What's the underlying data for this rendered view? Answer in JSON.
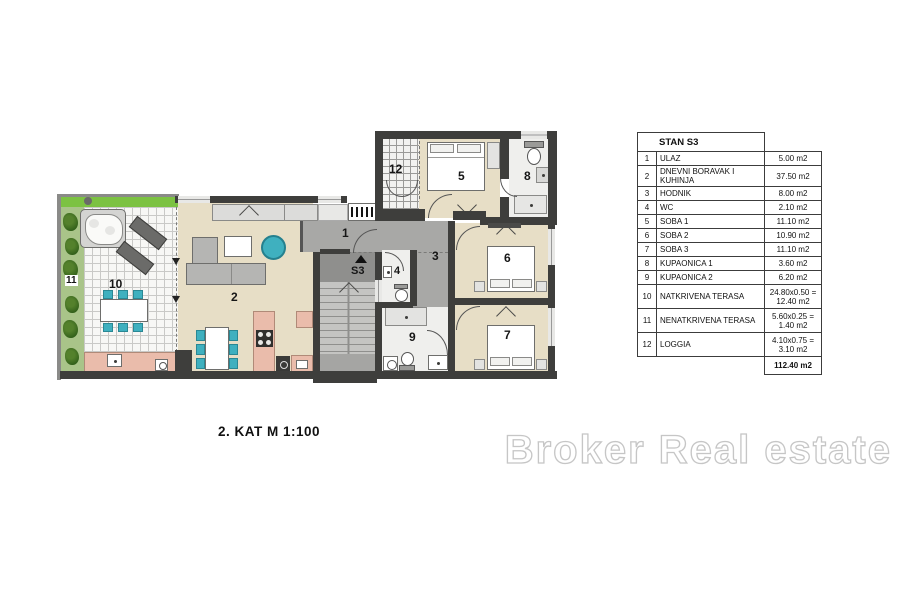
{
  "watermark": "Broker Real estate",
  "plan": {
    "floor_label": "2. KAT  M 1:100",
    "labels": {
      "r1": "1",
      "r2": "2",
      "r3": "3",
      "r4": "4",
      "r5": "5",
      "r6": "6",
      "r7": "7",
      "r8": "8",
      "r9": "9",
      "r10": "10",
      "r11": "11",
      "r12": "12",
      "unit": "S3"
    }
  },
  "colors": {
    "wall": "#3e3e3c",
    "room_floor": "#e7dec6",
    "hall_floor": "#a8a8a6",
    "terrace_green": "#7cc242",
    "kitchen_salmon": "#eabcab",
    "accent_teal": "#3fb0bf"
  },
  "table": {
    "title": "STAN S3",
    "rows": [
      {
        "num": "1",
        "name": "ULAZ",
        "area1": "5.00 m2",
        "area2": ""
      },
      {
        "num": "2",
        "name": "DNEVNI BORAVAK I KUHINJA",
        "area1": "37.50 m2",
        "area2": ""
      },
      {
        "num": "3",
        "name": "HODNIK",
        "area1": "8.00 m2",
        "area2": ""
      },
      {
        "num": "4",
        "name": "WC",
        "area1": "2.10 m2",
        "area2": ""
      },
      {
        "num": "5",
        "name": "SOBA 1",
        "area1": "11.10 m2",
        "area2": ""
      },
      {
        "num": "6",
        "name": "SOBA 2",
        "area1": "10.90 m2",
        "area2": ""
      },
      {
        "num": "7",
        "name": "SOBA 3",
        "area1": "11.10 m2",
        "area2": ""
      },
      {
        "num": "8",
        "name": "KUPAONICA 1",
        "area1": "3.60 m2",
        "area2": ""
      },
      {
        "num": "9",
        "name": "KUPAONICA 2",
        "area1": "6.20 m2",
        "area2": ""
      },
      {
        "num": "10",
        "name": "NATKRIVENA TERASA",
        "area1": "24.80x0.50 =",
        "area2": "12.40 m2"
      },
      {
        "num": "11",
        "name": "NENATKRIVENA TERASA",
        "area1": "5.60x0.25 =",
        "area2": "1.40 m2"
      },
      {
        "num": "12",
        "name": "LOGGIA",
        "area1": "4.10x0.75 =",
        "area2": "3.10 m2"
      }
    ],
    "total": "112.40 m2"
  }
}
